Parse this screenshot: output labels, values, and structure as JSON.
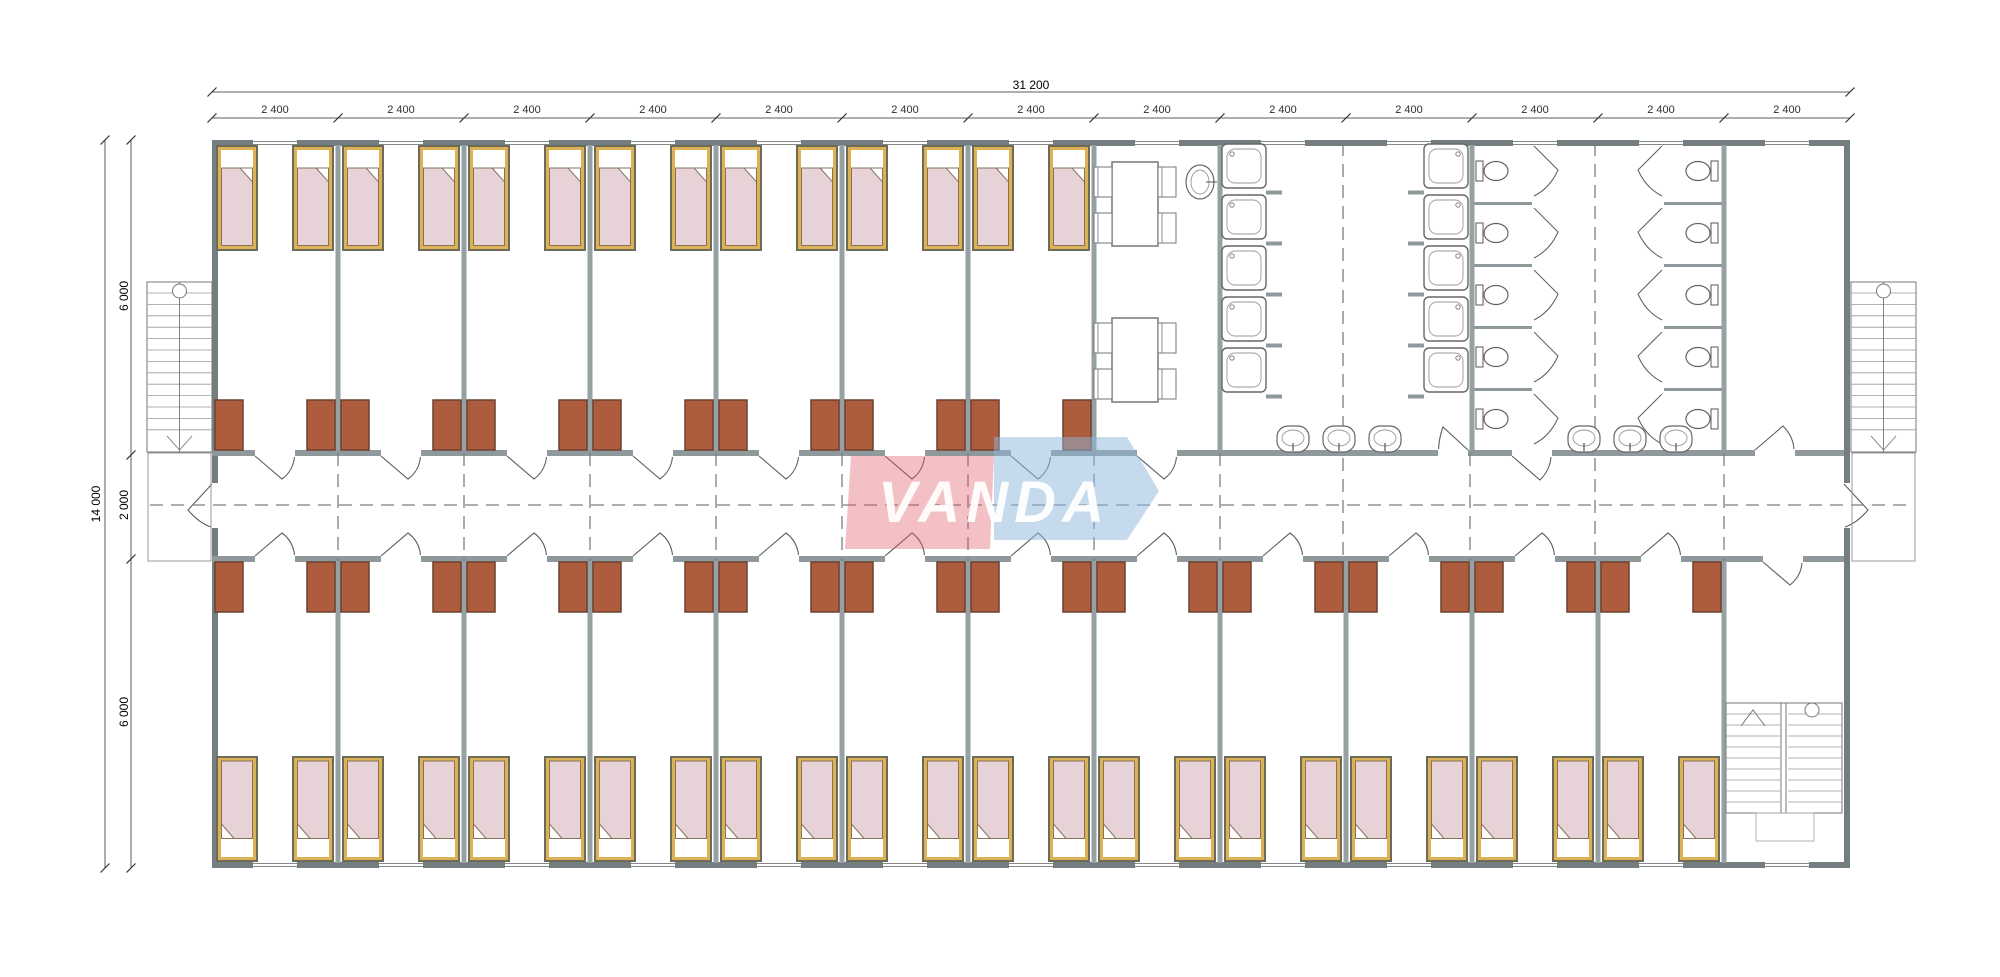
{
  "drawing_title": "VANDA modular dormitory floor plan",
  "logo": {
    "text": "VANDA",
    "red_color": "#e05a66",
    "blue_color": "#8db6dc"
  },
  "dimensions": {
    "horizontal": {
      "total": "31 200",
      "module": "2 400",
      "module_count": 13
    },
    "vertical": {
      "total": "14 000",
      "top_band": "6 000",
      "corridor": "2 000",
      "bottom_band": "6 000"
    }
  },
  "rooms": {
    "top_row": [
      "bedroom x7",
      "dining room",
      "washroom (showers)",
      "washroom (showers)",
      "toilets",
      "toilets",
      "store room"
    ],
    "bottom_row": [
      "bedroom x12",
      "stair hall"
    ],
    "corridor": "central corridor with doors to every room"
  },
  "fixtures": {
    "beds": 38,
    "desk_cabinets": 38,
    "shower_stalls": 10,
    "toilet_stalls": 10,
    "wash_basins": 6,
    "hand_basin": 1,
    "dining_tables": 2,
    "chairs": 8,
    "external_staircases": 2,
    "internal_staircases": 1,
    "windows": 26
  },
  "colors": {
    "ext_wall": "#747d7f",
    "partition": "#96a1a3",
    "corridor_wall": "#8f999b",
    "bed_frame": "#6b6b57",
    "bed_gold": "#ddb257",
    "mattress": "#e6d2d7",
    "mattress_edge": "#857259",
    "desk": "#ad5c3d",
    "desk_edge": "#6d4030",
    "line": "#5a5f60",
    "dash": "#7a7f80",
    "dim_text": "#2e2e2e"
  }
}
